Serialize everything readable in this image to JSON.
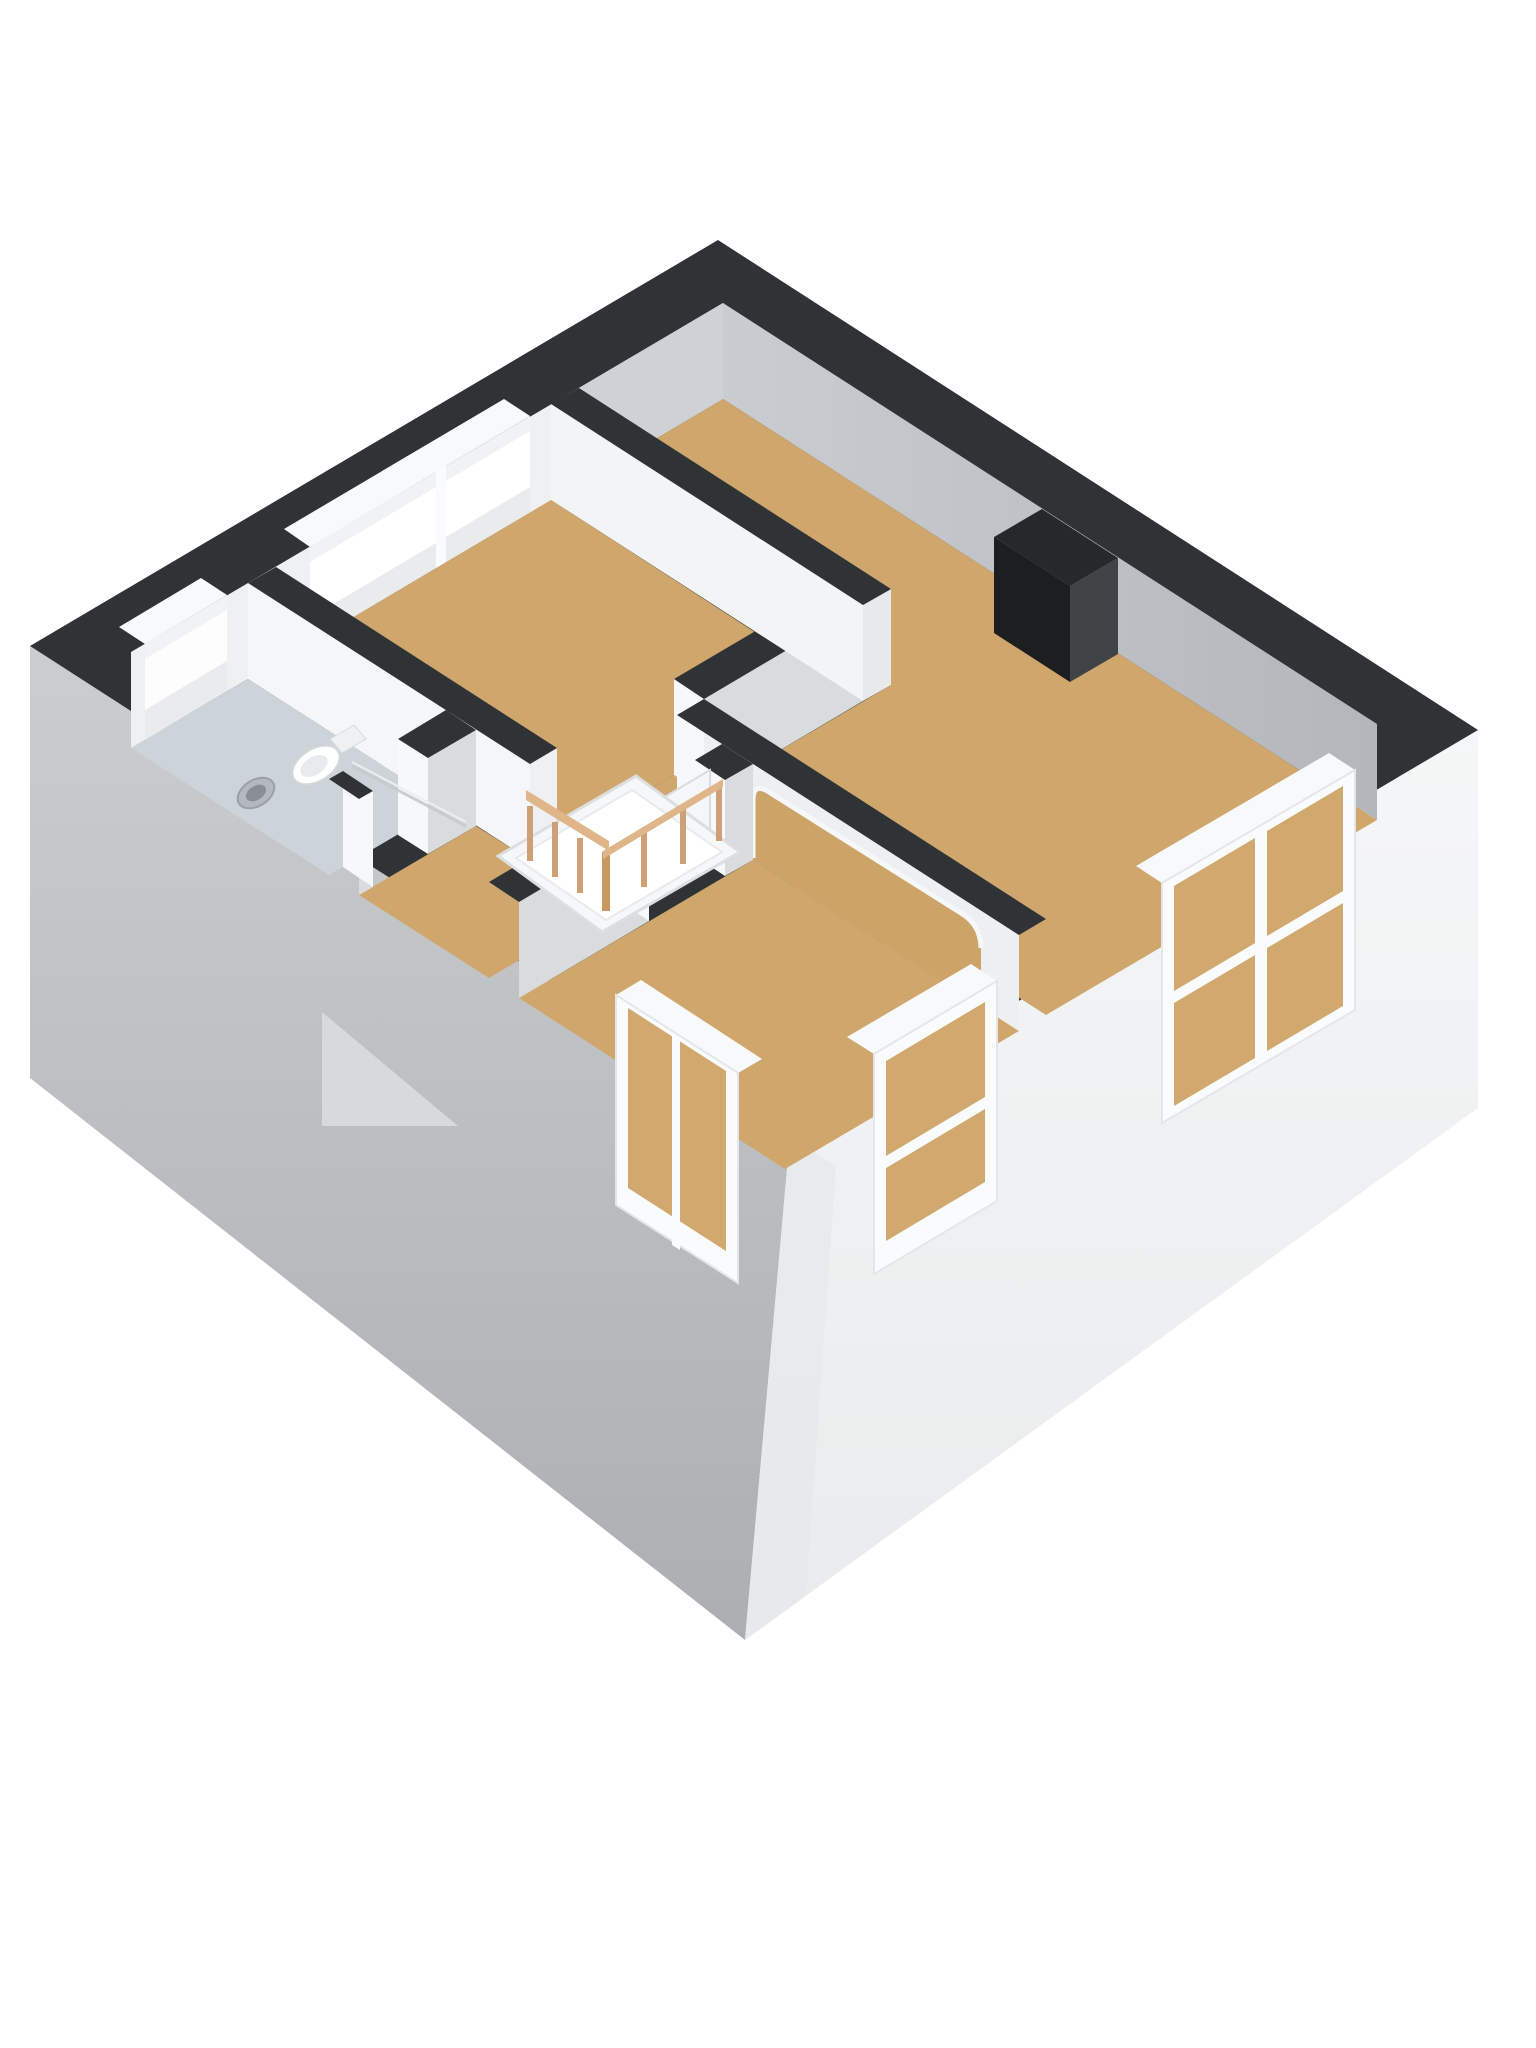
{
  "meta": {
    "kind": "3d-floorplan-render",
    "background": "#ffffff"
  },
  "palette": {
    "wall_top_band": "#303336",
    "exterior_sw_face_top": "#cbcdcf",
    "exterior_sw_face_bottom": "#acafb1",
    "exterior_se_face": "#f4f5f6",
    "interior_face_bright": "#f5f6f8",
    "interior_face_shaded": "#d9dbdd",
    "ne_inner_face": "#c9cdd1",
    "floor_wood": "#cfa76d",
    "floor_bathroom": "#ccd3d9",
    "stairwell_opening": "#595d61",
    "stair_flight": "#f6f7f8",
    "railing_wood": "#cfa076",
    "railing_rail": "#dfb58a",
    "chimney_dark": "#1c1e20",
    "chimney_side": "#404346",
    "window_frame": "#fafbfc",
    "window_interior_view": "#d1a96f",
    "door_leaf": "#f4f6f7",
    "fixture_white": "#fdfefe"
  },
  "scene": {
    "width": 1536,
    "height": 2048,
    "shapes": [
      {
        "n": "exterior-wall-sw-face",
        "k": "polygon",
        "p": "30,646 790,1136 745,1640 30,1078",
        "f": "url(#gradSW)"
      },
      {
        "n": "lower-floor-gable",
        "k": "polygon",
        "p": "322,1012 458,1126 322,1126",
        "f": "#d7d9da"
      },
      {
        "n": "exterior-wall-se-face",
        "k": "polygon",
        "p": "790,1136 1478,730 1478,1108 745,1640",
        "f": "url(#gradSE)"
      },
      {
        "n": "exterior-corner-shade",
        "k": "polygon",
        "p": "790,1136 745,1640 806,1596 836,1166",
        "f": "#e6e8e9",
        "o": 0.7
      },
      {
        "n": "wall-top-band",
        "k": "polygon",
        "p": "718,240 1478,730 790,1136 30,646",
        "f": "#303336"
      },
      {
        "n": "nw-wall-inner-face",
        "k": "polygon",
        "p": "131,652 723,303 723,399 131,748",
        "f": "#eef0f2"
      },
      {
        "n": "nw-wall-inner-face-shaded",
        "k": "polygon",
        "p": "579,388 723,303 723,399 579,484",
        "f": "#ced2d6"
      },
      {
        "n": "ne-wall-inner-face",
        "k": "polygon",
        "p": "723,303 1377,724 1377,820 723,399",
        "f": "url(#gradNE)"
      },
      {
        "n": "bathroom-floor",
        "k": "polygon",
        "p": "131,748 248,679 446,806 329,875",
        "f": "#ccd3d9"
      },
      {
        "n": "bedroom-top-floor",
        "k": "polygon",
        "p": "276,663 551,500 832,682 557,844",
        "f": "#cfa76d"
      },
      {
        "n": "bedroom-right-floor",
        "k": "polygon",
        "p": "579,484 723,399 1377,820 1046,1015 704,795 891,685",
        "f": "#cfa76d"
      },
      {
        "n": "landing-floor",
        "k": "polygon",
        "p": "359,895 476,826 530,860 674,775 704,795 677,811 722,840 489,978",
        "f": "#cfa76d"
      },
      {
        "n": "bottom-room-floor",
        "k": "polygon",
        "p": "519,998 753,860 1019,1031 785,1169",
        "f": "#cfa76d"
      },
      {
        "n": "big-window-head-notch",
        "k": "polygon",
        "p": "284,529 504,399 530,416 310,547",
        "f": "#f8f9fa"
      },
      {
        "n": "big-window-head",
        "k": "polygon",
        "p": "310,547 530,416 530,431 310,562",
        "f": "#f1f2f4"
      },
      {
        "n": "big-window-glass",
        "k": "polygon",
        "p": "310,562 530,431 530,487 310,618",
        "f": "#ffffff"
      },
      {
        "n": "big-window-sill",
        "k": "polygon",
        "p": "310,618 530,487 530,512 310,643",
        "f": "#e9ebed"
      },
      {
        "n": "big-window-mullion",
        "k": "polygon",
        "p": "436,470 446,464 446,562 436,568",
        "f": "#fafbfc"
      },
      {
        "n": "small-window-head-notch",
        "k": "polygon",
        "p": "119,627 201,578 227,595 145,644",
        "f": "#f8f9fa"
      },
      {
        "n": "small-window-head",
        "k": "polygon",
        "p": "145,644 227,595 227,610 145,659",
        "f": "#f1f2f4"
      },
      {
        "n": "small-window-glass",
        "k": "polygon",
        "p": "145,659 227,610 227,661 145,710",
        "f": "#fdfdfe"
      },
      {
        "n": "small-window-sill",
        "k": "polygon",
        "p": "145,710 227,661 227,691 145,740",
        "f": "#e9ebed"
      },
      {
        "n": "wall-bathroom-right-face",
        "k": "polygon",
        "p": "248,583 530,764 530,860 248,679",
        "f": "#f5f6f8"
      },
      {
        "n": "wall-bathroom-right-cap",
        "k": "polygon",
        "p": "530,764 557,748 557,844 530,860",
        "f": "#eef0f1"
      },
      {
        "n": "wall-bathroom-right-band",
        "k": "polygon",
        "p": "248,583 276,567 557,748 530,764",
        "f": "#303336"
      },
      {
        "n": "wall-bathroom-bottom-face-1",
        "k": "polygon",
        "p": "359,799 373,791 373,887 359,895",
        "f": "#d9dbdd"
      },
      {
        "n": "wall-bathroom-doorjamb-1",
        "k": "polygon",
        "p": "343,771 373,791 373,887 343,867",
        "f": "#f7f8fa"
      },
      {
        "n": "wall-bathroom-bottom-band-1",
        "k": "polygon",
        "p": "329,779 343,771 373,791 359,799",
        "f": "#303336"
      },
      {
        "n": "wall-bathroom-bottom-face-2",
        "k": "polygon",
        "p": "428,758 476,730 476,826 428,854",
        "f": "#d9dbdd"
      },
      {
        "n": "wall-bathroom-doorjamb-2",
        "k": "polygon",
        "p": "398,739 428,758 428,854 398,835",
        "f": "#f7f8fa"
      },
      {
        "n": "wall-bathroom-bottom-band-2",
        "k": "polygon",
        "p": "398,739 446,710 476,730 428,758",
        "f": "#303336"
      },
      {
        "n": "wall-toproom-jamb",
        "k": "polygon",
        "p": "674,679 704,699 704,795 674,775",
        "f": "#f7f8fa"
      },
      {
        "n": "wall-toproom-bottom-face",
        "k": "polygon",
        "p": "704,699 863,605 863,701 704,795",
        "f": "#d9dbdd"
      },
      {
        "n": "wall-toproom-bottom-band",
        "k": "polygon",
        "p": "674,679 832,586 863,605 704,699",
        "f": "#303336"
      },
      {
        "n": "wall-divider-face",
        "k": "polygon",
        "p": "551,404 863,605 863,701 551,500",
        "f": "#f2f4f5"
      },
      {
        "n": "wall-divider-cap",
        "k": "polygon",
        "p": "863,605 891,589 891,685 863,701",
        "f": "#e7e9eb"
      },
      {
        "n": "wall-divider-band",
        "k": "polygon",
        "p": "551,404 579,388 891,589 863,605",
        "f": "#303336"
      },
      {
        "n": "wall-arch-face",
        "k": "polygon",
        "p": "677,715 1019,935 1019,1031 677,811",
        "f": "#edeff1"
      },
      {
        "n": "arch-opening",
        "k": "path",
        "d": "M753,860 L753,800 Q753,782 769,792 L961,913 Q981,925 981,950 L981,1007 Z",
        "f": "#cda468"
      },
      {
        "n": "arch-reveal",
        "k": "path",
        "d": "M753,858 L753,800 Q753,782 769,792 L961,913 Q981,925 981,948",
        "f": "none",
        "s": "#f6f7f8",
        "w": 5
      },
      {
        "n": "wall-arch-cap",
        "k": "polygon",
        "p": "677,715 704,699 704,795 677,811",
        "f": "#f7f8fa"
      },
      {
        "n": "wall-arch-band",
        "k": "polygon",
        "p": "677,715 704,699 1046,919 1019,935",
        "f": "#303336"
      },
      {
        "n": "wall-bottomroom-face-1",
        "k": "polygon",
        "p": "519,902 649,825 649,921 519,998",
        "f": "#d9dbdd"
      },
      {
        "n": "wall-bottomroom-doorjamb-1",
        "k": "polygon",
        "p": "619,805 649,825 649,921 619,901",
        "f": "#f7f8fa"
      },
      {
        "n": "wall-bottomroom-band-1",
        "k": "polygon",
        "p": "489,882 619,805 649,825 519,902",
        "f": "#303336"
      },
      {
        "n": "wall-bottomroom-face-2",
        "k": "polygon",
        "p": "725,780 753,764 753,860 725,876",
        "f": "#d9dbdd"
      },
      {
        "n": "wall-bottomroom-doorjamb-2",
        "k": "polygon",
        "p": "695,760 725,780 725,876 695,856",
        "f": "#f7f8fa"
      },
      {
        "n": "wall-bottomroom-band-2",
        "k": "polygon",
        "p": "695,760 722,744 753,764 725,780",
        "f": "#303336"
      },
      {
        "n": "interior-door",
        "k": "polygon",
        "p": "634,815 710,770 710,866 634,911",
        "f": "#f4f6f7",
        "s": "#d9dcde",
        "w": 2
      },
      {
        "n": "door-handle",
        "k": "line",
        "x1": 687,
        "y1": 834,
        "x2": 701,
        "y2": 826,
        "s": "#9aa1a6",
        "w": 5
      },
      {
        "n": "se-window-1-head",
        "k": "polygon",
        "p": "1136,866 1329,753 1355,770 1162,883",
        "f": "#f8f9fa"
      },
      {
        "n": "se-window-1-frame",
        "k": "polygon",
        "p": "1162,883 1355,770 1355,1010 1162,1123",
        "f": "#fafbfc",
        "s": "#e4e6e8",
        "w": 2
      },
      {
        "n": "se-window-1-glass-left",
        "k": "polygon",
        "p": "1174,886 1255,838 1255,1058 1174,1106",
        "f": "#d1a96f"
      },
      {
        "n": "se-window-1-glass-right",
        "k": "polygon",
        "p": "1267,831 1343,786 1343,1006 1267,1051",
        "f": "#d1a96f"
      },
      {
        "n": "se-window-1-rail",
        "k": "polygon",
        "p": "1174,991 1343,891 1343,903 1174,1003",
        "f": "#fafbfc"
      },
      {
        "n": "se-window-2-head",
        "k": "polygon",
        "p": "847,1037 971,964 997,981 874,1054",
        "f": "#f8f9fa"
      },
      {
        "n": "se-window-2-frame",
        "k": "polygon",
        "p": "874,1054 997,981 997,1201 874,1274",
        "f": "#fafbfc",
        "s": "#e4e6e8",
        "w": 2
      },
      {
        "n": "se-window-2-glass",
        "k": "polygon",
        "p": "886,1061 985,1002 985,1182 886,1241",
        "f": "#d1a96f"
      },
      {
        "n": "se-window-2-rail",
        "k": "polygon",
        "p": "886,1156 985,1097 985,1109 886,1168",
        "f": "#fafbfc"
      },
      {
        "n": "sw-window-head",
        "k": "polygon",
        "p": "641,980 762,1059 738,1073 616,995",
        "f": "#f8f9fa"
      },
      {
        "n": "sw-window-frame",
        "k": "polygon",
        "p": "616,995 738,1073 738,1283 616,1205",
        "f": "#fafbfc",
        "s": "#e4e6e8",
        "w": 2
      },
      {
        "n": "sw-window-glass",
        "k": "polygon",
        "p": "628,1008 726,1071 726,1251 628,1188",
        "f": "#d1a96f"
      },
      {
        "n": "sw-window-mullion",
        "k": "polygon",
        "p": "672,1035 680,1040 680,1250 672,1245",
        "f": "#fafbfc"
      },
      {
        "n": "stairwell-opening",
        "k": "polygon",
        "p": "530,860 647,791 722,840 606,909",
        "f": "#595d61"
      },
      {
        "n": "stair-flight",
        "k": "polygon",
        "p": "498,856 636,776 740,852 602,932",
        "f": "#f6f7f8",
        "s": "#dcdee0",
        "w": 3
      },
      {
        "n": "stair-flight-panel",
        "k": "polygon",
        "p": "516,858 632,790 722,852 606,920",
        "f": "#ffffff",
        "s": "#e8eaec",
        "w": 2
      },
      {
        "n": "railing-post-1",
        "k": "polygon",
        "p": "527,806 533,806 533,861 527,861",
        "f": "#cfa076"
      },
      {
        "n": "railing-post-2",
        "k": "polygon",
        "p": "552,822 558,822 558,877 552,877",
        "f": "#cfa076"
      },
      {
        "n": "railing-post-3",
        "k": "polygon",
        "p": "577,838 583,838 583,893 577,893",
        "f": "#cfa076"
      },
      {
        "n": "railing-post-corner",
        "k": "polygon",
        "p": "602,852 610,852 610,911 602,911",
        "f": "#c8985f"
      },
      {
        "n": "railing-post-4",
        "k": "polygon",
        "p": "641,832 647,832 647,887 641,887",
        "f": "#cfa076"
      },
      {
        "n": "railing-post-5",
        "k": "polygon",
        "p": "680,809 686,809 686,864 680,864",
        "f": "#cfa076"
      },
      {
        "n": "railing-post-6",
        "k": "polygon",
        "p": "716,786 722,786 722,841 716,841",
        "f": "#cfa076"
      },
      {
        "n": "railing-rail-west",
        "k": "polygon",
        "p": "526,800 609,851 609,841 526,790",
        "f": "#dfb58a"
      },
      {
        "n": "railing-rail-south",
        "k": "polygon",
        "p": "603,851 723,779 723,787 603,859",
        "f": "#dfb58a"
      },
      {
        "n": "chimney-top",
        "k": "polygon",
        "p": "994,537 1042,509 1118,558 1070,586",
        "f": "#26292b"
      },
      {
        "n": "chimney-front",
        "k": "polygon",
        "p": "994,537 1070,586 1070,682 994,633",
        "f": "#1c1e20"
      },
      {
        "n": "chimney-side",
        "k": "polygon",
        "p": "1070,586 1118,558 1118,654 1070,682",
        "f": "#404346"
      },
      {
        "n": "toilet-tank",
        "k": "polygon",
        "p": "330,739 354,725 366,739 342,753",
        "f": "#eef0f2",
        "s": "#d8dbdd",
        "w": 1
      },
      {
        "n": "toilet-bowl",
        "k": "ellipse",
        "cx": 316,
        "cy": 765,
        "rx": 26,
        "ry": 16,
        "t": "rotate(-32 316 765)",
        "f": "#fdfefe",
        "s": "#d5d8da",
        "w": 2
      },
      {
        "n": "toilet-seat",
        "k": "ellipse",
        "cx": 314,
        "cy": 766,
        "rx": 15,
        "ry": 9,
        "t": "rotate(-32 314 766)",
        "f": "#e8ebed"
      },
      {
        "n": "bathroom-sink",
        "k": "ellipse",
        "cx": 256,
        "cy": 793,
        "rx": 20,
        "ry": 13,
        "t": "rotate(-32 256 793)",
        "f": "#b3b9be",
        "s": "#9aa1a7",
        "w": 2
      },
      {
        "n": "bathroom-sink-basin",
        "k": "ellipse",
        "cx": 256,
        "cy": 793,
        "rx": 11,
        "ry": 7,
        "t": "rotate(-32 256 793)",
        "f": "#878e94"
      },
      {
        "n": "shower-screen-top",
        "k": "line",
        "x1": 352,
        "y1": 762,
        "x2": 466,
        "y2": 822,
        "s": "#eceeef",
        "w": 2
      },
      {
        "n": "shower-screen",
        "k": "line",
        "x1": 352,
        "y1": 766,
        "x2": 466,
        "y2": 826,
        "s": "#c6cacc",
        "w": 3,
        "o": 0.9
      }
    ]
  }
}
